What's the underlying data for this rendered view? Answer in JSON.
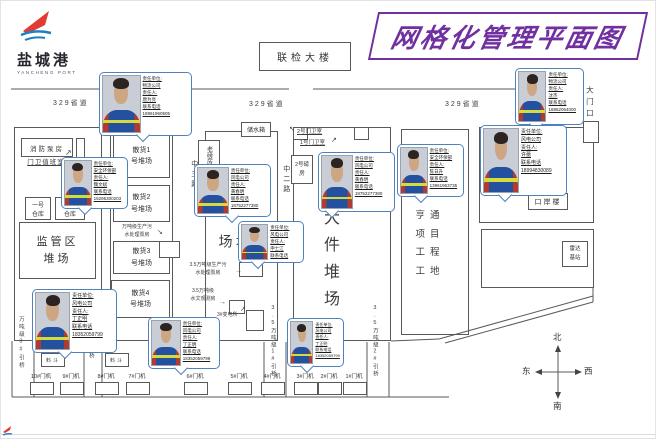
{
  "title": "网格化管理平面图",
  "logo": {
    "name": "盐城港",
    "sub": "YANCHENG PORT"
  },
  "top": {
    "inspection_building": "联检大楼",
    "provincial_road": "329省道",
    "gate": "大门口"
  },
  "left_zone": {
    "fire_pump": "消防泵房",
    "gate_duty": "门卫值班室",
    "warehouse1": [
      "一号",
      "仓库"
    ],
    "warehouse2": [
      "二号",
      "仓库"
    ],
    "regulatory_yard": [
      "监管区",
      "堆场"
    ]
  },
  "bulk_yards": [
    [
      "散货1",
      "号堆场"
    ],
    [
      "散货2",
      "号堆场"
    ],
    [
      "散货3",
      "号堆场"
    ],
    [
      "散货4",
      "号堆场"
    ]
  ],
  "roads": {
    "mid3": "中三路",
    "mid2": "中二路"
  },
  "center_zone": {
    "water_tank": "储水箱",
    "old_weigh": "老磅房",
    "weigh2": "2号磅房",
    "stack_yard": "堆场",
    "guard2": "2号门卫室",
    "guard1": "1号门卫室",
    "large_yard": "大件堆场"
  },
  "right_zone": {
    "hengtong": [
      "亨通",
      "项目",
      "工程",
      "工地"
    ],
    "port_building": "口岸楼",
    "radar": [
      "雷达",
      "基站"
    ]
  },
  "annotations": {
    "pump_10k": [
      "万吨级生产污",
      "水处理泵房"
    ],
    "pump_35k": [
      "3.5万吨级生产污",
      "水处理泵房"
    ],
    "hydrology": [
      "3.5万吨级",
      "水文观测房"
    ],
    "substation": "3#变电所",
    "hopper": "料斗"
  },
  "bridges": [
    "万吨级3#引桥",
    "2#引桥",
    "3.5万吨级1#引桥",
    "3.5万吨级2#引桥"
  ],
  "cranes": [
    "10#门机",
    "9#门机",
    "8#门机",
    "7#门机",
    "6#门机",
    "5#门机",
    "4#门机",
    "3#门机",
    "2#门机",
    "1#门机"
  ],
  "compass": {
    "north": "北",
    "south": "南",
    "east": "东",
    "west": "西"
  },
  "card_labels": {
    "unit": "责任单位:",
    "person": "责任人:",
    "phone": "联系电话"
  },
  "cards": [
    {
      "unit": "物流公司",
      "person": "唐为亮",
      "phone": "18961960505"
    },
    {
      "unit": "安全环保部",
      "person": "魏文斌",
      "phone": "15295300203"
    },
    {
      "unit": "风电公司",
      "person": "黄春明",
      "phone": "18752277380"
    },
    {
      "unit": "风电公司",
      "person": "申士江",
      "phone": "15358295533"
    },
    {
      "unit": "风电公司",
      "person": "黄春明",
      "phone": "18752277380"
    },
    {
      "unit": "物流公司",
      "person": "沈杰",
      "phone": "18862064000"
    },
    {
      "unit": "风电公司",
      "person": "许蕾",
      "phone": "18994830089"
    },
    {
      "unit": "安全环保部",
      "person": "陈日升",
      "phone": "13961963735"
    },
    {
      "unit": "风电公司",
      "person": "丁正明",
      "phone": "18352059799"
    },
    {
      "unit": "风电公司",
      "person": "丁正明",
      "phone": "18352059799"
    },
    {
      "unit": "风电公司",
      "person": "丁正明",
      "phone": "18352059799"
    }
  ],
  "colors": {
    "title_purple": "#7030a0",
    "card_border": "#4f81bd",
    "logo_red": "#e03c31",
    "logo_blue": "#1e7fc2"
  }
}
